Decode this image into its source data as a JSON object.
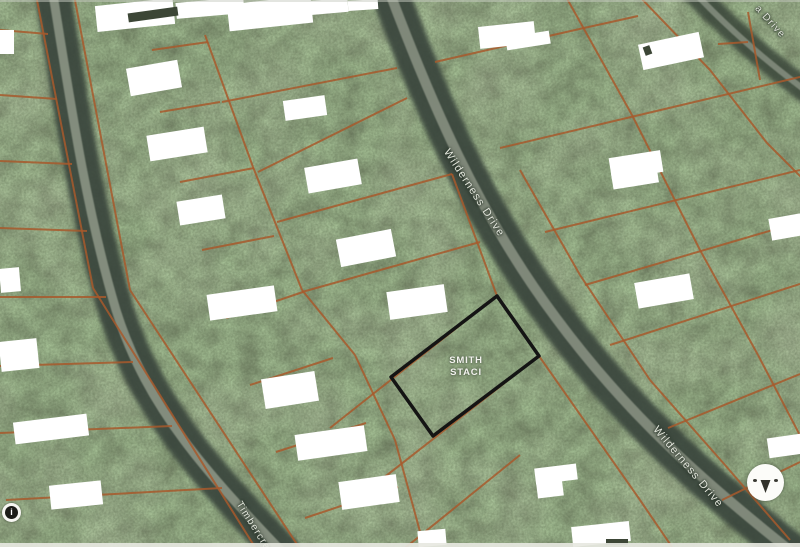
{
  "map": {
    "parcel": {
      "owner_line1": "SMITH",
      "owner_line2": "STACI"
    },
    "street_labels": [
      {
        "id": "wilderness-upper",
        "name": "Wilderness Drive"
      },
      {
        "id": "wilderness-lower",
        "name": "Wilderness Drive"
      },
      {
        "id": "corner-drive",
        "name": "a Drive"
      },
      {
        "id": "timber",
        "name": "Timbercre"
      }
    ],
    "icons": [
      {
        "name": "north-arrow"
      },
      {
        "name": "info-marker",
        "glyph": "i"
      }
    ],
    "colors": {
      "parcel_line": "#a85a2c",
      "highlight_outline": "#141414",
      "redaction": "#ffffff",
      "redaction_mark": "#3c4636",
      "road_dark": "#39443a",
      "road_light": "#9aa192",
      "forest_base": "#4e5a44",
      "road_label": "#e4e7dd"
    }
  }
}
